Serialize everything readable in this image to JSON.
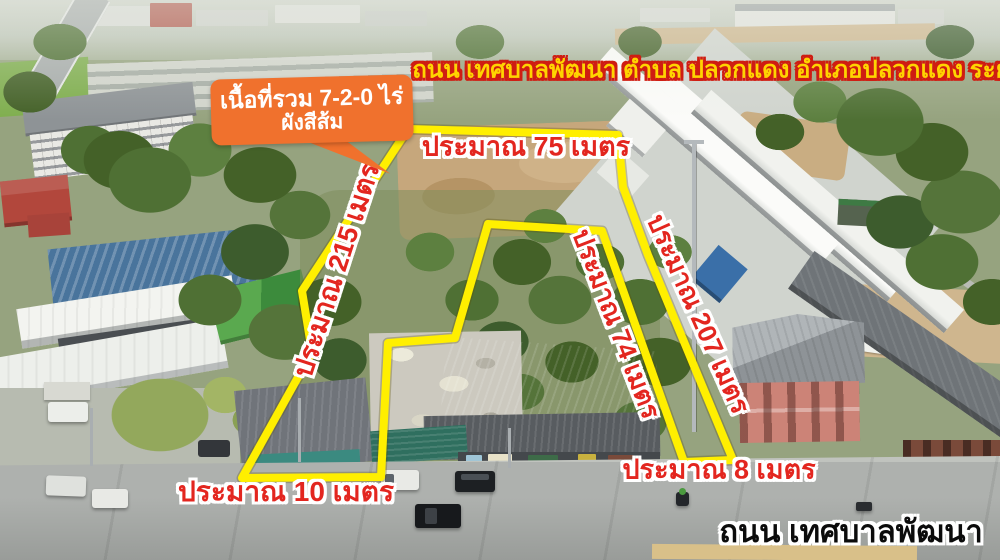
{
  "banner": {
    "text": "ถนน เทศบาลพัฒนา ตำบล ปลวกแดง อำเภอปลวกแดง ระยอง"
  },
  "callout": {
    "line1": "เนื้อที่รวม 7-2-0 ไร่",
    "line2": "ผังสีส้ม"
  },
  "measurements": {
    "top": "ประมาณ 75 เมตร",
    "left": "ประมาณ 215 เมตร",
    "inner": "ประมาณ 74 เมตร",
    "right": "ประมาณ 207 เมตร",
    "frontage_left": "ประมาณ 10 เมตร",
    "frontage_right": "ประมาณ 8 เมตร"
  },
  "road": {
    "label": "ถนน เทศบาลพัฒนา"
  },
  "colors": {
    "boundary_yellow": "#ffef00",
    "measurement_red": "#e3261f",
    "measurement_outline": "#ffffff",
    "banner_yellow": "#ffd400",
    "banner_outline": "#cf1d12",
    "callout_orange": "#f0712d",
    "road_label_black": "#0b0b0b"
  }
}
